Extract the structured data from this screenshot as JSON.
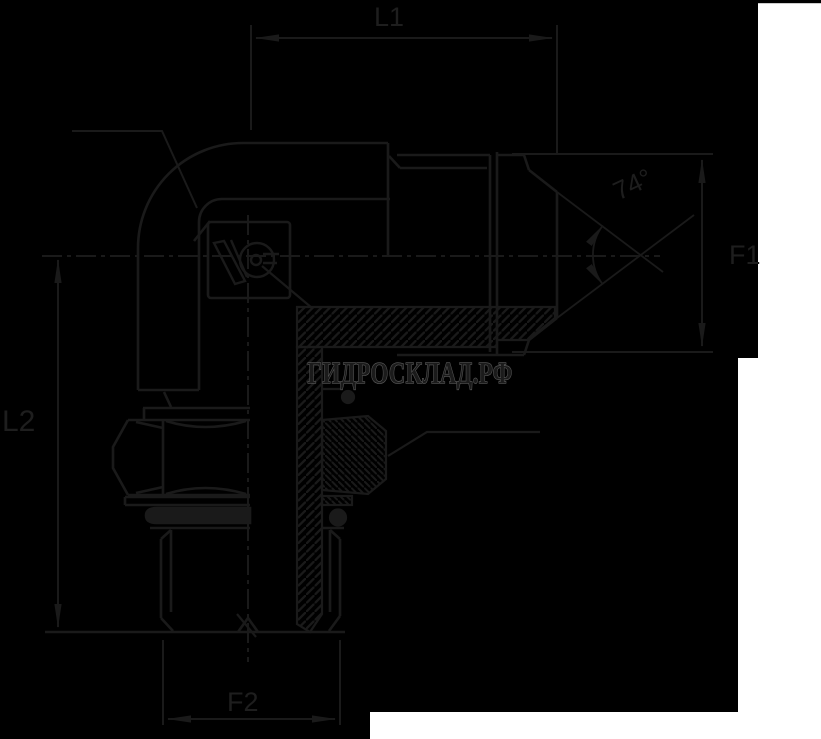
{
  "drawing": {
    "subject": "90-degree elbow hydraulic adapter, half-section technical drawing",
    "colors": {
      "page_background": "#ffffff",
      "drawing_background": "#000000",
      "line": "#1a1a1a",
      "watermark_fill": "#1b1b1b",
      "watermark_outline": "#5c5c5c"
    },
    "labels": {
      "l1": "L1",
      "l2": "L2",
      "f1": "F1",
      "f2": "F2",
      "angle": "74°"
    },
    "watermark": {
      "text": "ГИДРОСКЛАД.РФ"
    }
  }
}
